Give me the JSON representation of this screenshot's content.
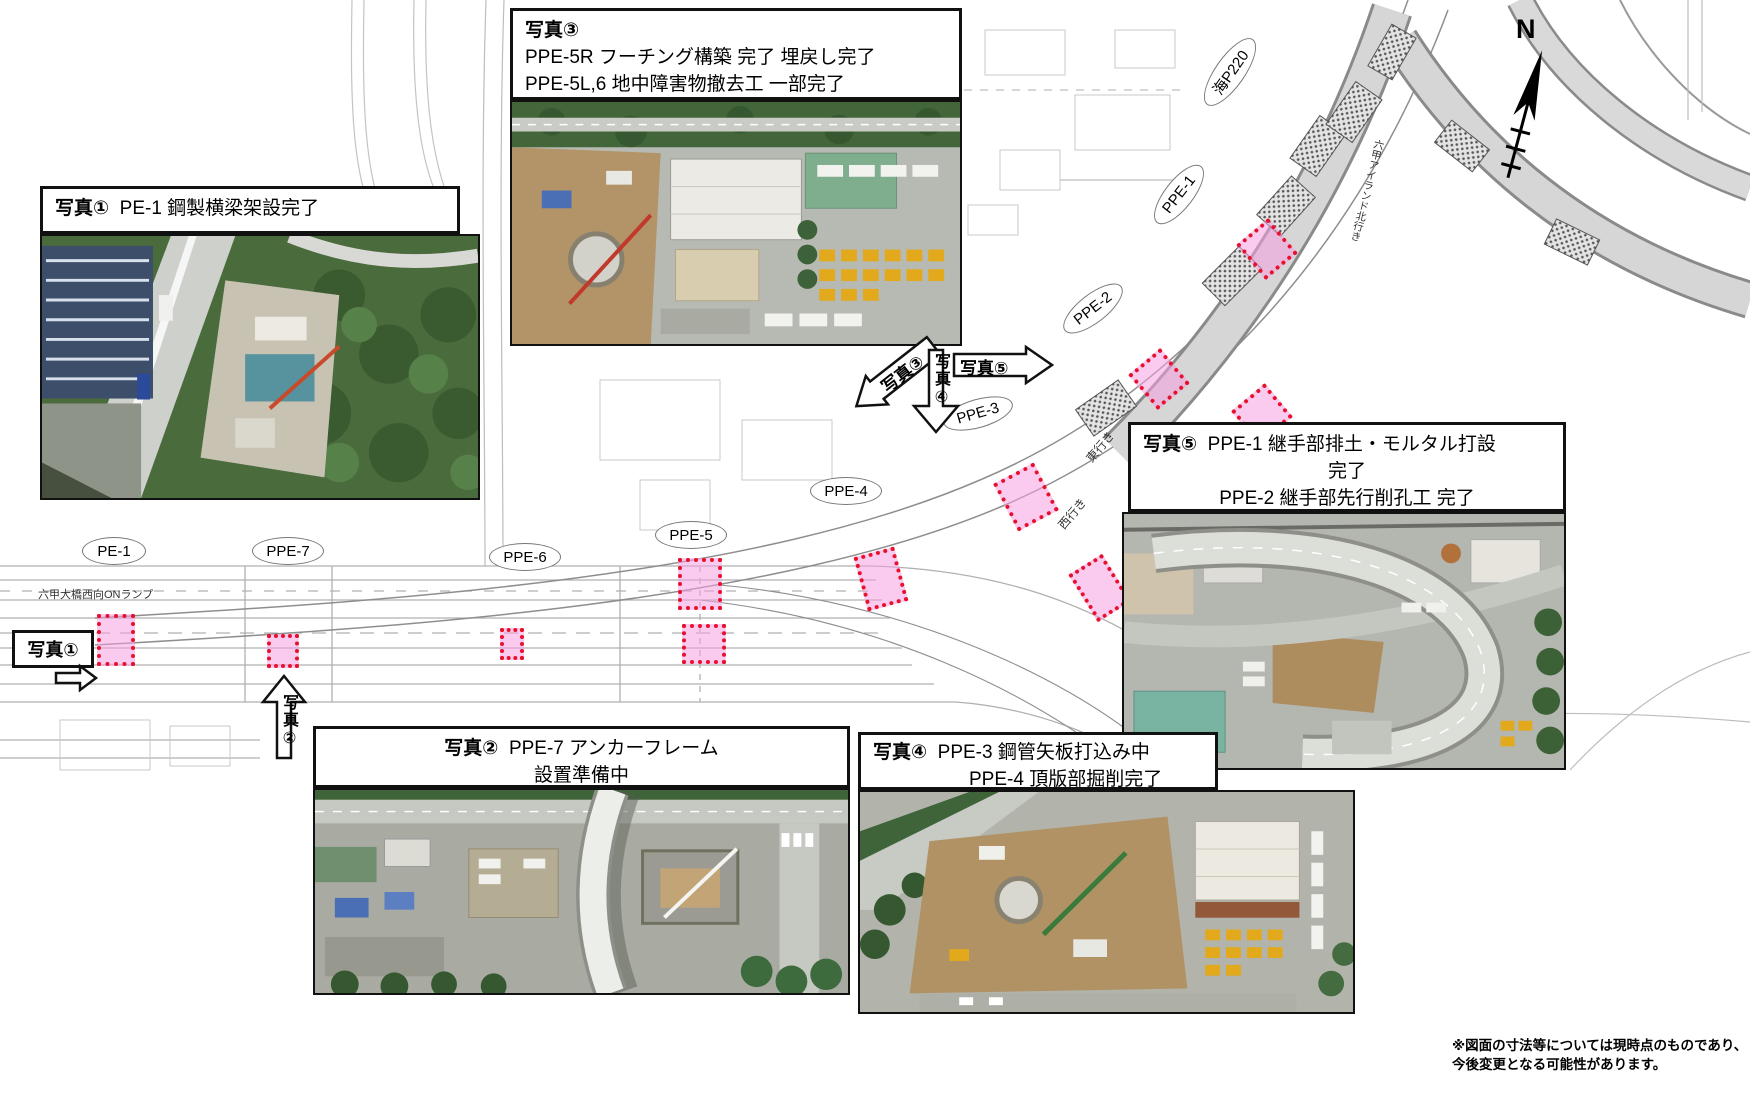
{
  "compass": {
    "n": "N"
  },
  "callouts": {
    "photo1": {
      "title": "写真①",
      "line1": "PE-1  鋼製横梁架設完了"
    },
    "photo2": {
      "title": "写真②",
      "line1": "PPE-7  アンカーフレーム",
      "line2": "設置準備中"
    },
    "photo3": {
      "title": "写真③",
      "line1": "PPE-5R  フーチング構築  完了  埋戻し完了",
      "line2": "PPE-5L,6  地中障害物撤去工  一部完了"
    },
    "photo4": {
      "title": "写真④",
      "line1": "PPE-3  鋼管矢板打込み中",
      "line2": "PPE-4  頂版部掘削完了"
    },
    "photo5": {
      "title": "写真⑤",
      "line1": "PPE-1  継手部排土・モルタル打設",
      "line2": "完了",
      "line3": "PPE-2  継手部先行削孔工  完了"
    }
  },
  "arrow_labels": {
    "a1": "写真①",
    "a2": "写真②",
    "a3": "写真③",
    "a4": "写真④",
    "a5": "写真⑤"
  },
  "plan_labels": {
    "pe1": "PE-1",
    "ppe7": "PPE-7",
    "ppe6": "PPE-6",
    "ppe5": "PPE-5",
    "ppe4": "PPE-4",
    "ppe3": "PPE-3",
    "ppe2": "PPE-2",
    "ppe1": "PPE-1",
    "umi_p220": "海P220",
    "rokko_island": "六甲アイランド北行き",
    "on_ramp": "六甲大橋西向ONランプ",
    "higashi": "東行き",
    "nishi": "西行き"
  },
  "note": {
    "line1": "※図面の寸法等については現時点のものであり、",
    "line2": "今後変更となる可能性があります。"
  },
  "colors": {
    "marker_fill": "#f6a0e0",
    "marker_border": "#e8112d",
    "viaduct_gray": "#d6d6d6"
  }
}
